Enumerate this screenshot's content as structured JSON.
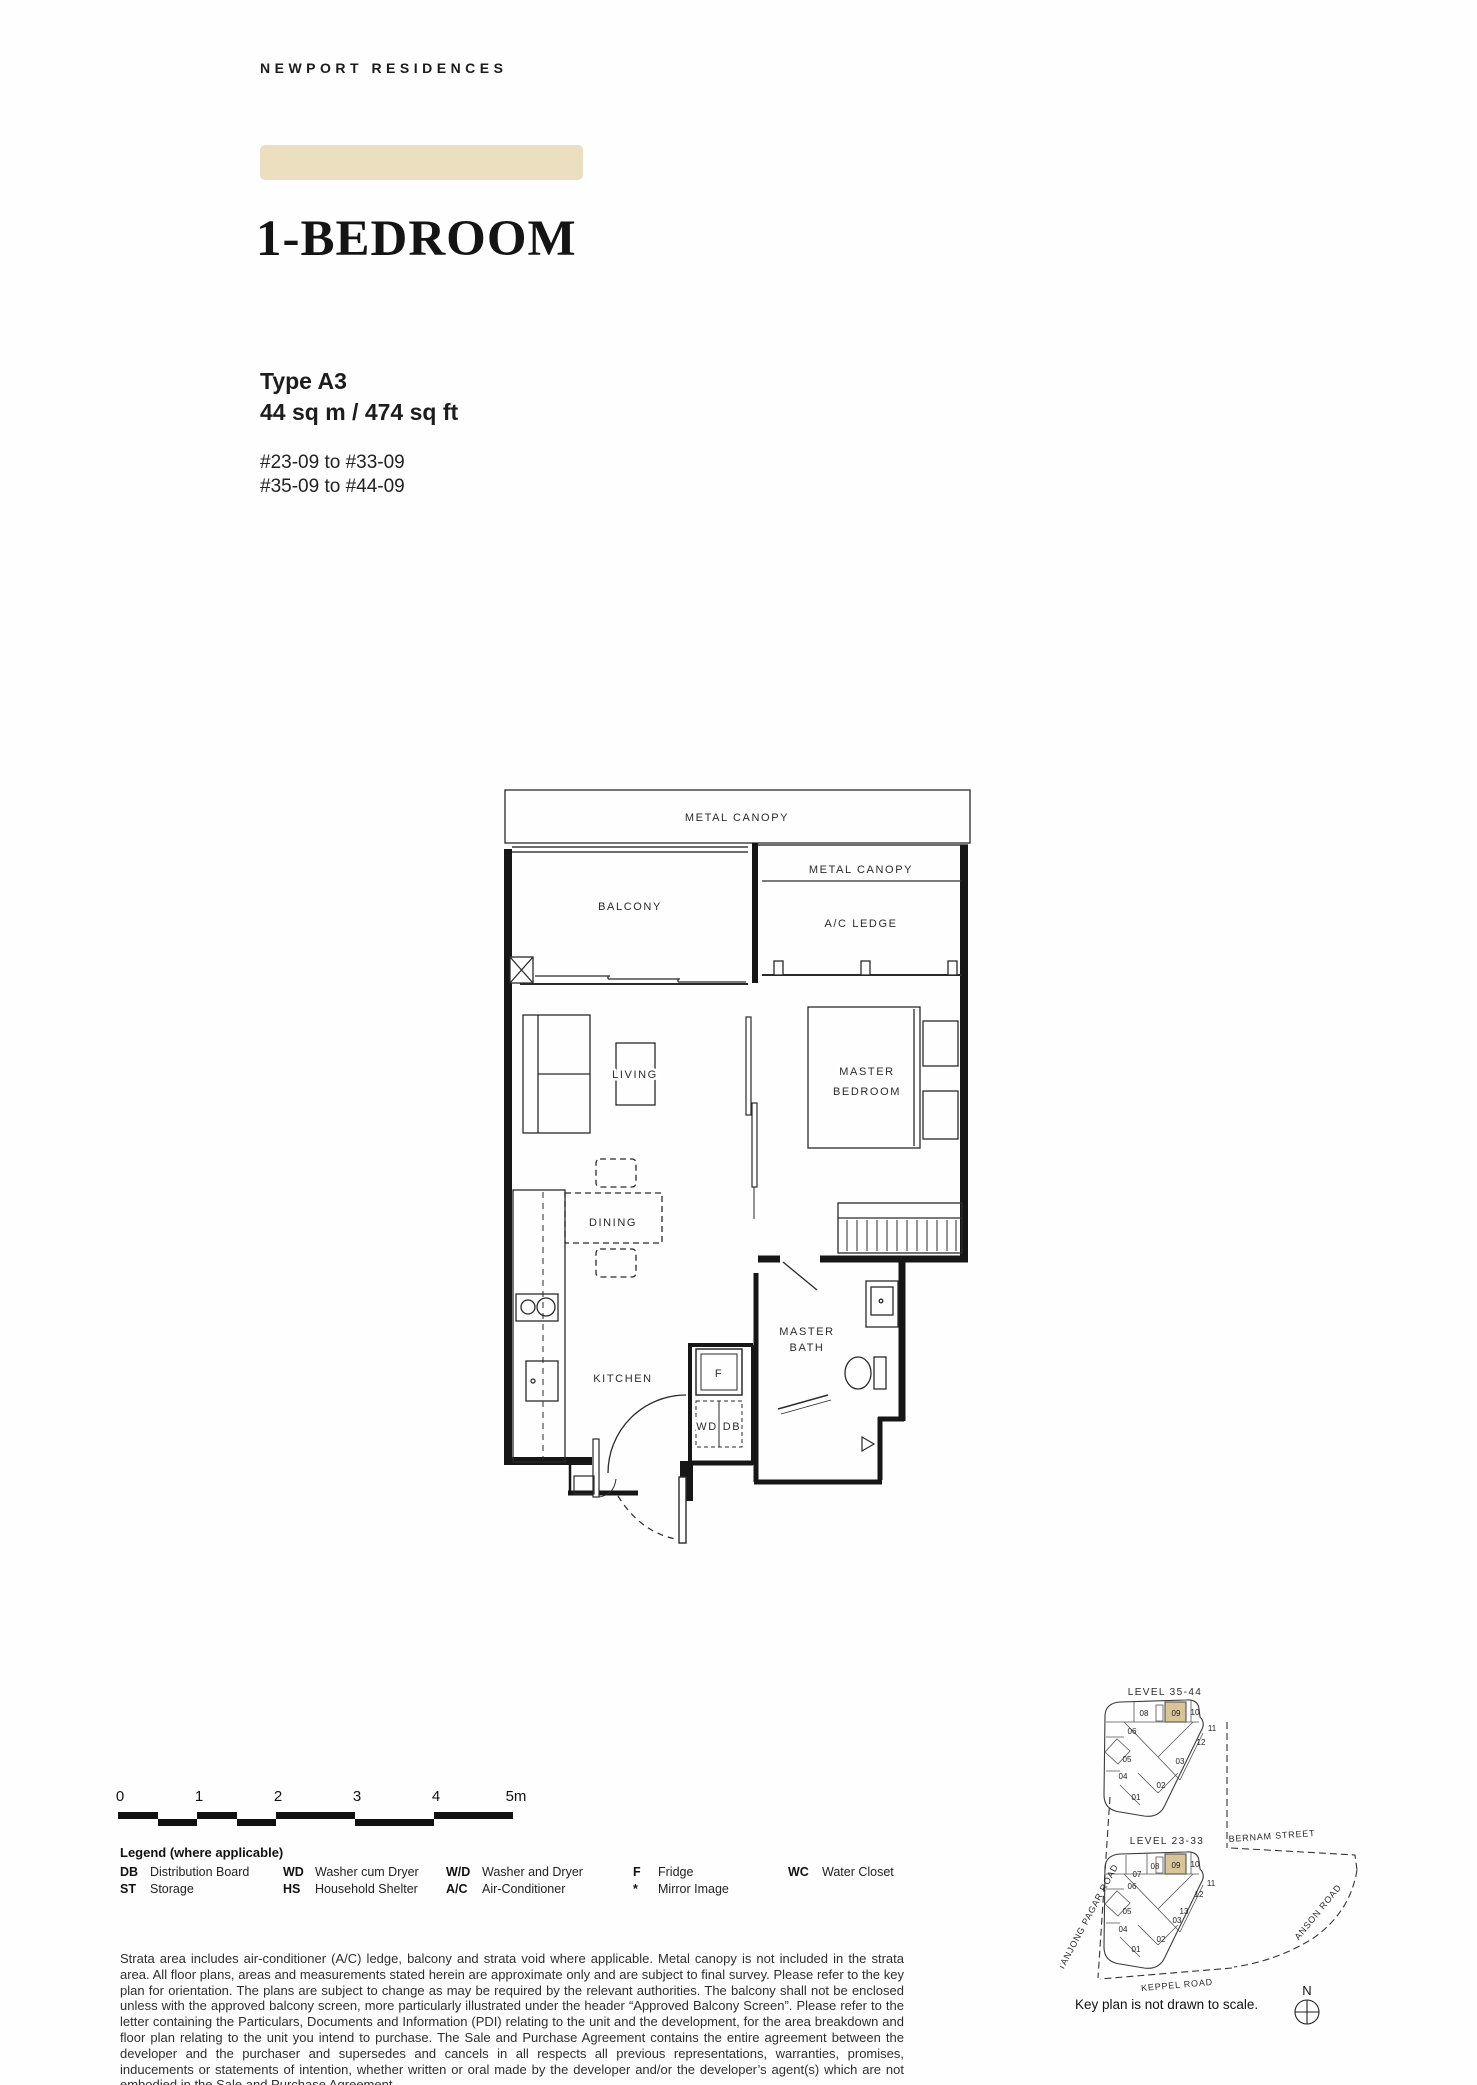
{
  "header": {
    "brand": "NEWPORT RESIDENCES"
  },
  "title": {
    "heading": "1-BEDROOM",
    "type": "Type A3",
    "area": "44 sq m / 474 sq ft",
    "unit_range_1": "#23-09 to #33-09",
    "unit_range_2": "#35-09 to #44-09"
  },
  "floor_plan": {
    "labels": {
      "metal_canopy": "METAL CANOPY",
      "metal_canopy_2": "METAL CANOPY",
      "balcony": "BALCONY",
      "ac_ledge": "A/C LEDGE",
      "living": "LIVING",
      "master": "MASTER",
      "bedroom": "BEDROOM",
      "dining": "DINING",
      "kitchen": "KITCHEN",
      "bath_master": "MASTER",
      "bath": "BATH",
      "fridge": "F",
      "wd": "WD",
      "db": "DB"
    }
  },
  "scale_bar": {
    "ticks": [
      "0",
      "1",
      "2",
      "3",
      "4",
      "5m"
    ]
  },
  "legend": {
    "title": "Legend (where applicable)",
    "items": [
      {
        "abbr": "DB",
        "label": "Distribution Board"
      },
      {
        "abbr": "ST",
        "label": "Storage"
      },
      {
        "abbr": "WD",
        "label": "Washer cum Dryer"
      },
      {
        "abbr": "HS",
        "label": "Household Shelter"
      },
      {
        "abbr": "W/D",
        "label": "Washer and Dryer"
      },
      {
        "abbr": "A/C",
        "label": "Air-Conditioner"
      },
      {
        "abbr": "F",
        "label": "Fridge"
      },
      {
        "abbr": "*",
        "label": "Mirror Image"
      },
      {
        "abbr": "WC",
        "label": "Water Closet"
      }
    ]
  },
  "disclaimer": {
    "text": "Strata area includes air-conditioner (A/C) ledge, balcony and strata void where applicable. Metal canopy is not included in the strata area. All floor plans, areas and measurements stated herein are approximate only and are subject to final survey. Please refer to the key plan for orientation. The plans are subject to change as may be required by the relevant authorities. The balcony shall not be enclosed unless with the approved balcony screen, more particularly illustrated under the header “Approved Balcony Screen”. Please refer to the letter containing the Particulars, Documents and Information (PDI) relating to the unit and the development, for the area breakdown and floor plan relating to the unit you intend to purchase. The Sale and Purchase Agreement contains the entire agreement between the developer and the purchaser and supersedes and cancels in all respects all previous representations, warranties, promises, inducements or statements of intention, whether written or oral made by the developer and/or the developer’s agent(s) which are not embodied in the Sale and Purchase Agreement."
  },
  "key_plan": {
    "upper": {
      "level": "LEVEL 35-44",
      "units": [
        "08",
        "09",
        "10",
        "11",
        "12",
        "06",
        "05",
        "04",
        "03",
        "02",
        "01"
      ]
    },
    "lower": {
      "level": "LEVEL 23-33",
      "units": [
        "07",
        "08",
        "09",
        "10",
        "11",
        "12",
        "13",
        "06",
        "05",
        "04",
        "03",
        "02",
        "01"
      ]
    },
    "streets": {
      "bernam": "BERNAM STREET",
      "tanjong_pagar": "TANJONG PAGAR ROAD",
      "anson": "ANSON ROAD",
      "keppel": "KEPPEL ROAD"
    },
    "note": "Key plan is not drawn to scale.",
    "compass": "N",
    "highlighted_unit": "09"
  },
  "colors": {
    "accent_bar": "#ebdfc0",
    "highlight": "#d9c49a"
  }
}
